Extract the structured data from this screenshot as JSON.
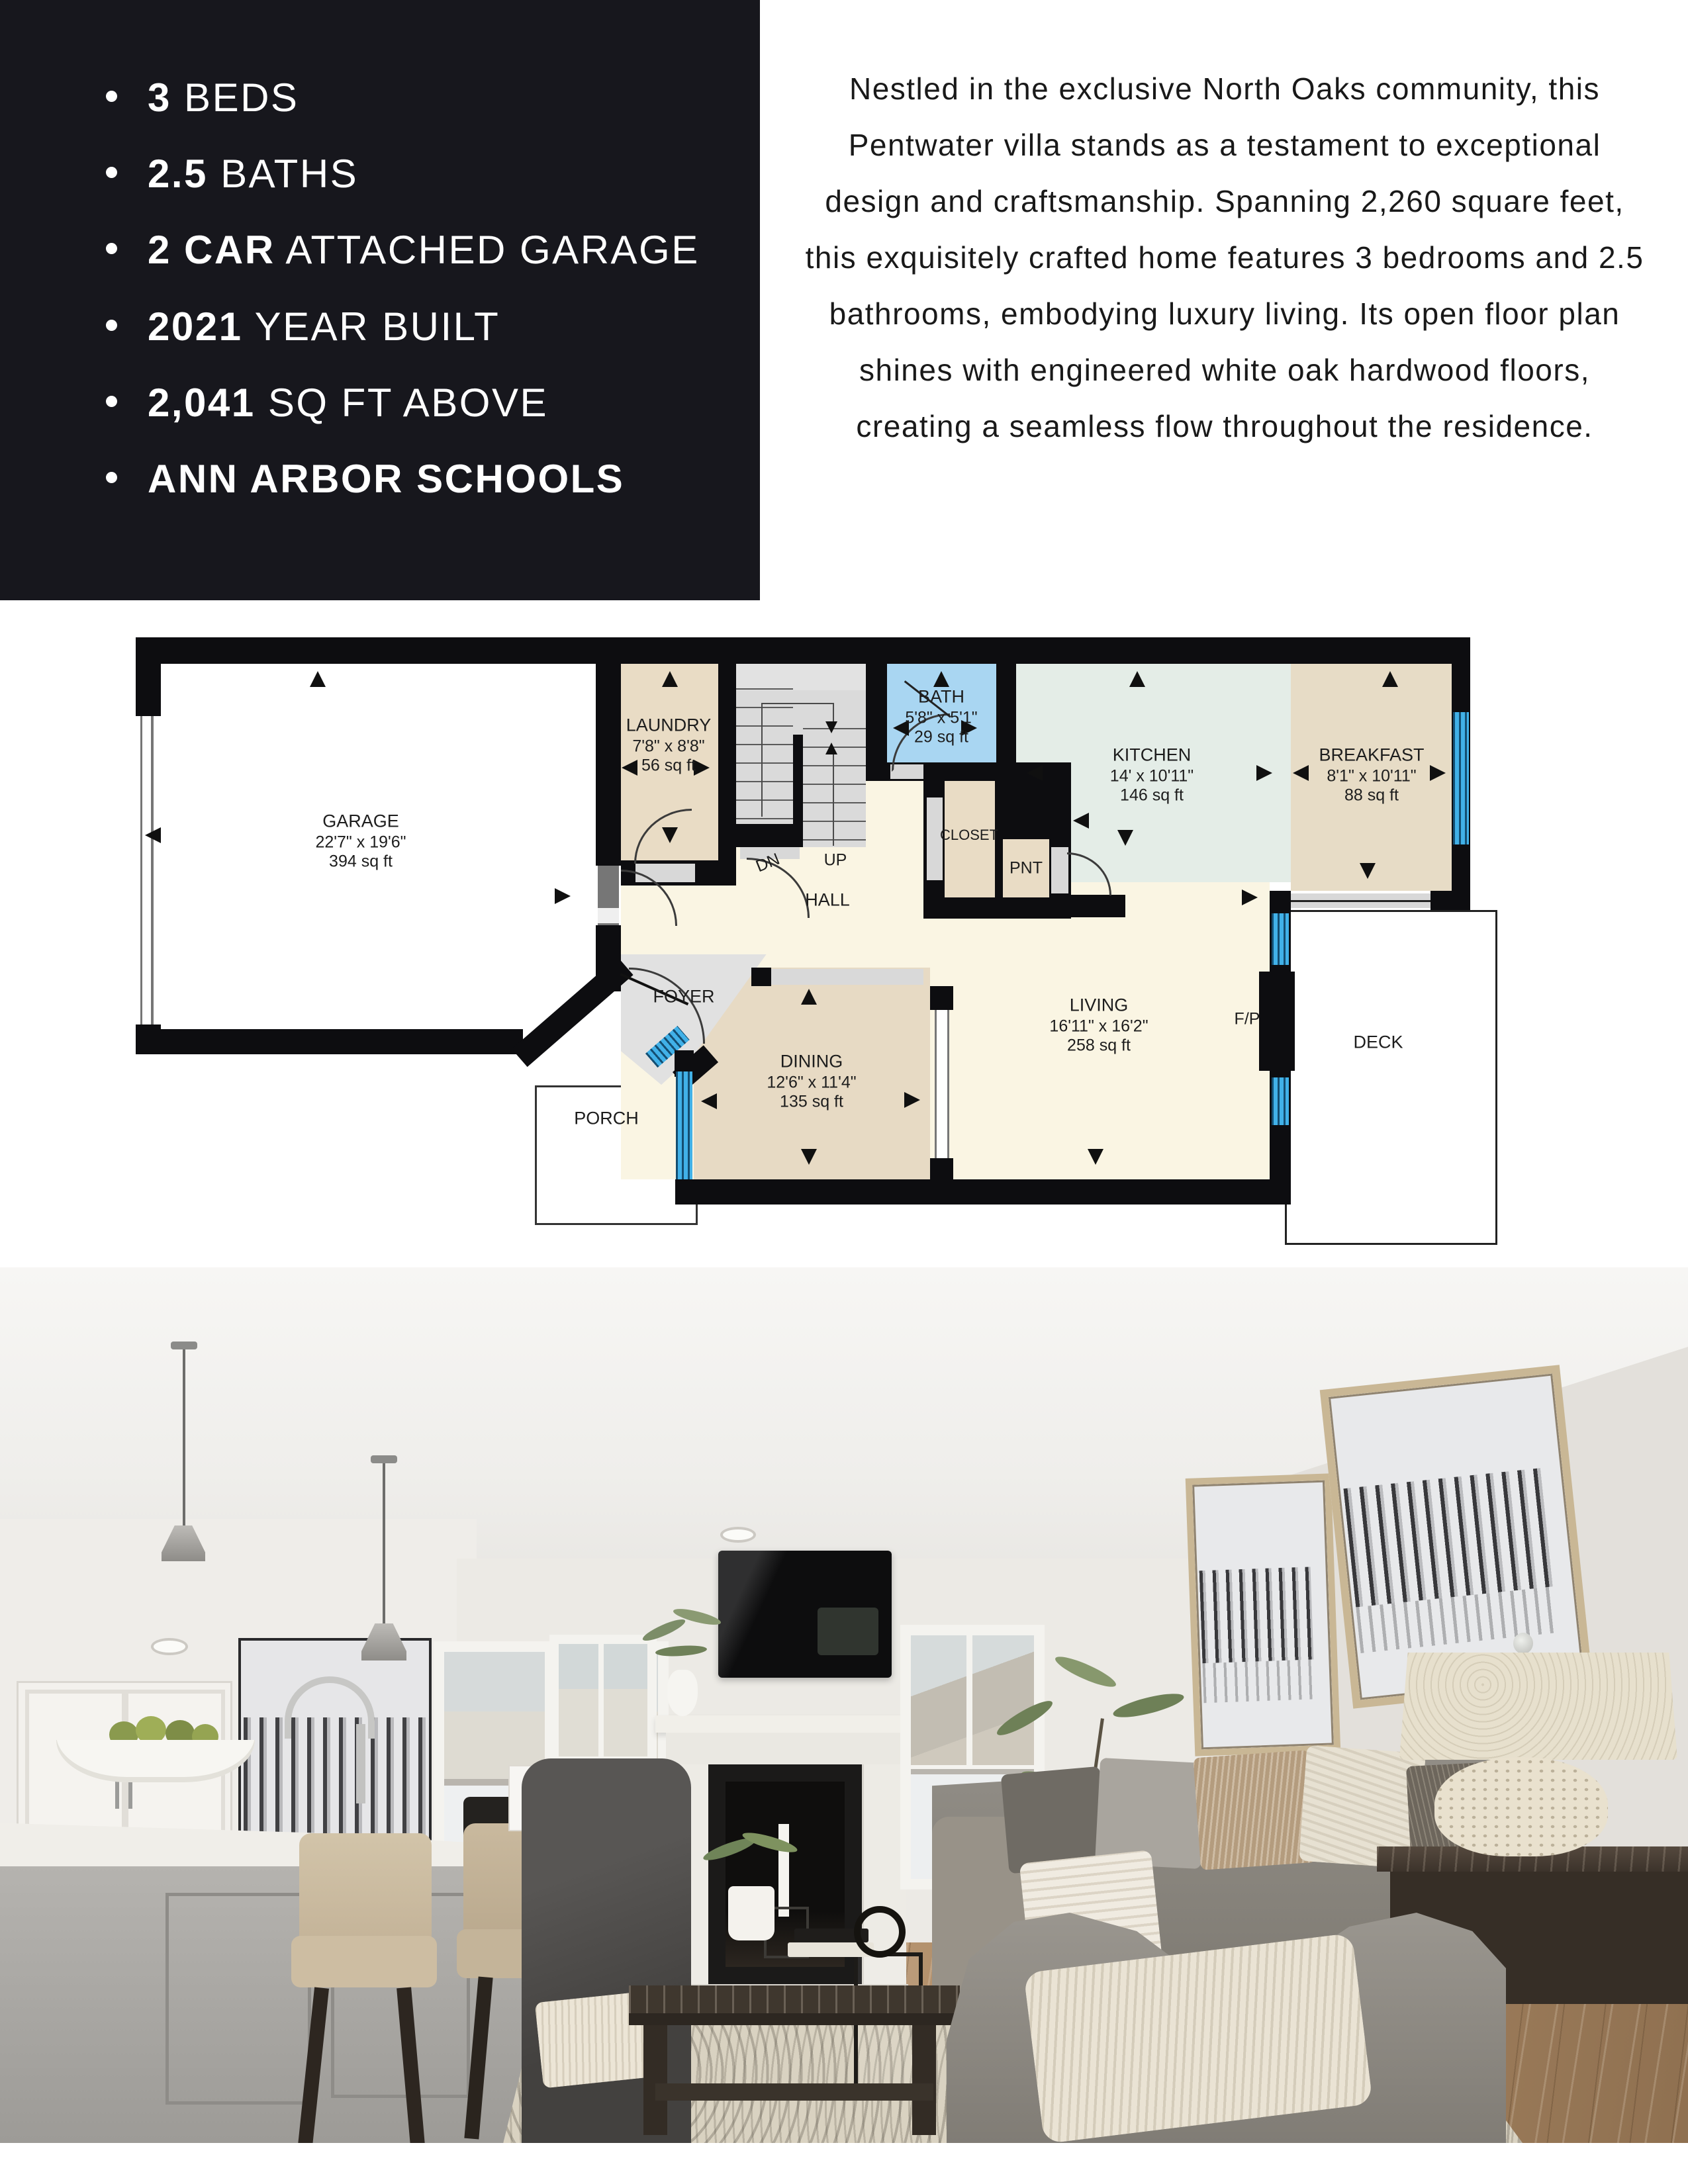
{
  "features": {
    "panel_bg": "#17171d",
    "items": [
      {
        "bold": "3",
        "rest": " BEDS"
      },
      {
        "bold": "2.5",
        "rest": " BATHS"
      },
      {
        "bold": "2 CAR",
        "rest": " ATTACHED GARAGE"
      },
      {
        "bold": "2021",
        "rest": " YEAR BUILT"
      },
      {
        "bold": "2,041",
        "rest": " SQ FT ABOVE"
      },
      {
        "bold": "ANN ARBOR SCHOOLS",
        "rest": ""
      }
    ]
  },
  "description": {
    "text": "Nestled in the exclusive North Oaks community, this Pentwater villa stands as a testament to exceptional design and craftsmanship. Spanning 2,260 square feet, this exquisitely crafted home features 3 bedrooms and 2.5 bathrooms, embodying luxury living. Its open floor plan shines with engineered white oak hardwood floors, creating a seamless flow throughout the residence."
  },
  "floor_plan": {
    "window_color": "#41b1e8",
    "wall_color": "#0d0d10",
    "rooms": {
      "garage": {
        "name": "GARAGE",
        "dims": "22'7\" x 19'6\"",
        "area": "394 sq ft"
      },
      "laundry": {
        "name": "LAUNDRY",
        "dims": "7'8\" x 8'8\"",
        "area": "56 sq ft"
      },
      "bath": {
        "name": "BATH",
        "dims": "5'8\" x 5'1\"",
        "area": "29 sq ft"
      },
      "kitchen": {
        "name": "KITCHEN",
        "dims": "14' x 10'11\"",
        "area": "146 sq ft"
      },
      "breakfast": {
        "name": "BREAKFAST",
        "dims": "8'1\" x 10'11\"",
        "area": "88 sq ft"
      },
      "dining": {
        "name": "DINING",
        "dims": "12'6\" x 11'4\"",
        "area": "135 sq ft"
      },
      "living": {
        "name": "LIVING",
        "dims": "16'11\" x 16'2\"",
        "area": "258 sq ft"
      }
    },
    "labels": {
      "closet": "CLOSET",
      "pantry": "PNT",
      "hall": "HALL",
      "foyer": "FOYER",
      "porch": "PORCH",
      "deck": "DECK",
      "down": "DN",
      "up": "UP",
      "fireplace": "F/P"
    }
  }
}
